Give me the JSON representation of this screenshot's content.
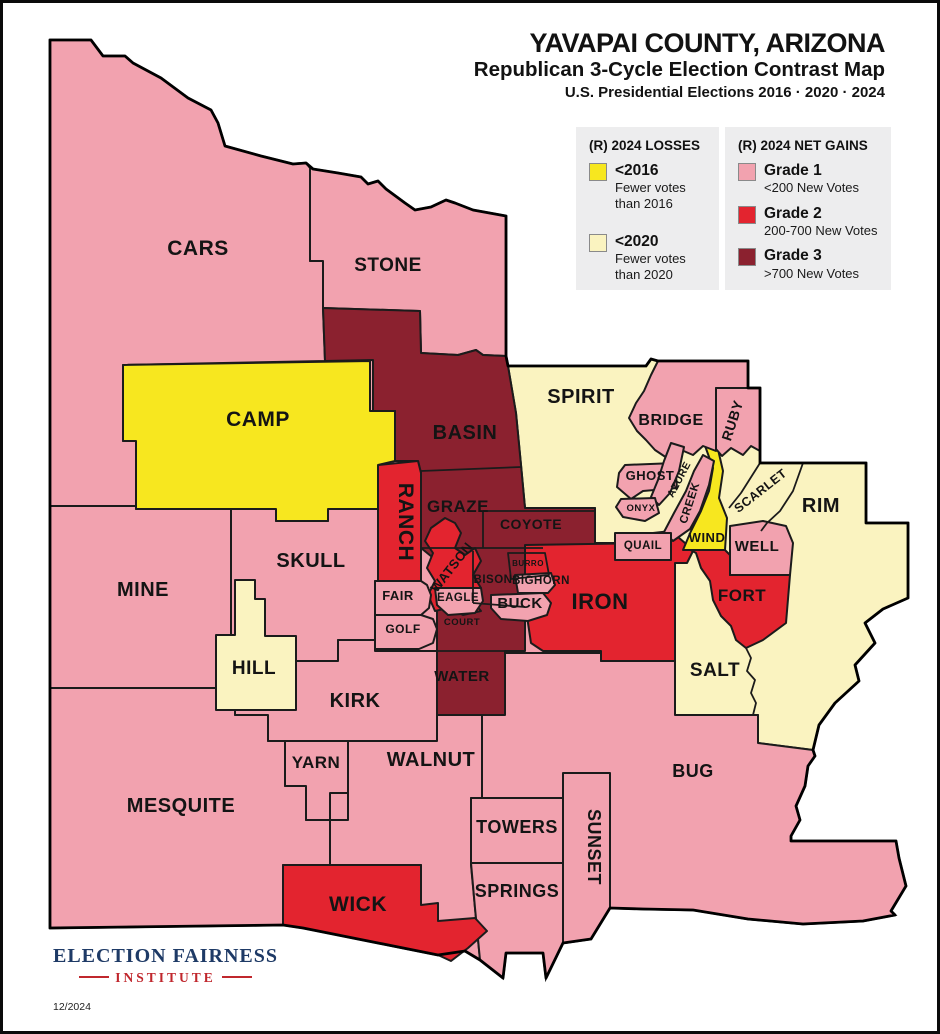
{
  "header": {
    "line1": "YAVAPAI COUNTY, ARIZONA",
    "line2": "Republican 3-Cycle Election Contrast Map",
    "line3": "U.S. Presidential Elections 2016 · 2020 · 2024"
  },
  "colors": {
    "g1": "#F2A2AF",
    "g2": "#E3242F",
    "g3": "#8B212F",
    "y16": "#F7E71F",
    "y20": "#FAF3C0",
    "stroke": "#1b1b1b",
    "legend_bg": "#EDEDEE",
    "logo_navy": "#1E3A66",
    "logo_red": "#C0272D"
  },
  "legend": {
    "losses": {
      "title": "(R) 2024 LOSSES",
      "items": [
        {
          "color_key": "y16",
          "label": "<2016",
          "desc1": "Fewer votes",
          "desc2": "than 2016"
        },
        {
          "color_key": "y20",
          "label": "<2020",
          "desc1": "Fewer votes",
          "desc2": "than 2020"
        }
      ]
    },
    "gains": {
      "title": "(R) 2024 NET GAINS",
      "items": [
        {
          "color_key": "g1",
          "label": "Grade 1",
          "desc1": "<200 New Votes"
        },
        {
          "color_key": "g2",
          "label": "Grade 2",
          "desc1": "200-700 New Votes"
        },
        {
          "color_key": "g3",
          "label": "Grade 3",
          "desc1": ">700 New Votes"
        }
      ]
    }
  },
  "footer": {
    "org1": "ELECTION FAIRNESS",
    "org2": "INSTITUTE",
    "date": "12/2024"
  },
  "map": {
    "outline": "47,37 88,37 100,53 122,53 130,60 158,75 185,95 208,107 215,120 222,143 258,153 290,161 303,160 310,166 335,170 358,174 365,181 375,178 383,186 402,200 412,207 428,204 443,197 452,200 470,207 503,213 503,353 505,363 643,363 648,356 655,358 745,358 745,385 757,385 757,460 863,460 863,520 905,520 905,595 880,606 862,620 872,640 852,662 856,678 832,700 816,722 810,747 812,753 805,763 802,783 793,803 797,817 788,833 788,838 893,838 896,855 903,883 888,908 892,912 860,918 800,921 745,916 690,907 640,906 607,905 588,936 560,940 543,975 540,950 503,950 500,975 477,957 462,948 435,952 300,925 280,922 47,925",
    "shapes": [
      {
        "name": "CARS",
        "color": "g1",
        "pts": "47,37 88,37 100,53 122,53 130,60 158,75 185,95 208,107 215,120 222,143 258,153 290,161 303,160 307,165 307,258 320,258 320,305 322,358 120,362 120,438 133,438 133,503 47,503"
      },
      {
        "name": "STONE",
        "color": "g1",
        "pts": "307,165 310,166 335,170 358,174 365,181 375,178 383,186 402,200 412,207 428,204 443,197 452,200 470,207 503,213 503,353 480,352 473,347 455,352 418,350 417,308 320,305 320,258 307,258"
      },
      {
        "name": "MINE",
        "color": "g1",
        "pts": "47,503 133,503 133,506 228,506 228,685 47,685"
      },
      {
        "name": "SKULL",
        "color": "g1",
        "pts": "228,506 273,506 273,518 325,518 325,506 375,506 375,578 372,578 372,637 335,637 335,658 228,658"
      },
      {
        "name": "MESQUITE",
        "color": "g1",
        "pts": "47,685 216,685 216,692 232,692 232,712 265,712 265,738 282,738 282,783 303,783 303,817 327,817 327,862 280,862 280,922 47,925"
      },
      {
        "name": "KIRK",
        "color": "g1",
        "pts": "228,658 335,658 335,637 372,637 372,648 434,648 434,738 265,738 265,712 232,712 232,692 216,692 216,685 228,685"
      },
      {
        "name": "YARN",
        "color": "g1",
        "pts": "282,738 345,738 345,790 327,790 327,817 303,817 303,783 282,783"
      },
      {
        "name": "WALNUT",
        "color": "g1",
        "pts": "345,738 434,738 434,712 479,712 479,795 468,795 468,862 472,905 477,957 462,948 435,952 418,905 418,862 327,862 327,817 345,817"
      },
      {
        "name": "TOWERS",
        "color": "g1",
        "pts": "468,795 560,795 560,860 468,860"
      },
      {
        "name": "SPRINGS",
        "color": "g1",
        "pts": "468,860 560,860 560,940 543,975 540,950 503,950 500,975 477,957 472,905"
      },
      {
        "name": "SUNSET",
        "color": "g1",
        "pts": "560,770 607,770 607,905 588,936 560,940"
      },
      {
        "name": "spirit-salt-rim-area",
        "color": "y20",
        "pts": "505,363 643,363 648,356 655,358 745,358 745,385 757,385 757,460 863,460 863,520 905,520 905,595 880,606 862,620 872,640 852,662 856,678 832,700 816,722 810,747 755,740 755,712 672,712 672,540 592,540 592,505 522,505 518,462 513,410"
      },
      {
        "name": "central-grade3-area",
        "color": "g3",
        "pts": "320,305 417,308 418,350 455,352 473,347 480,352 503,353 505,363 513,410 518,462 522,505 592,505 592,542 540,542 540,600 522,606 522,648 502,648 502,712 434,712 434,558 418,545 418,470 415,458 392,458 392,408 370,408 370,357 322,358"
      },
      {
        "name": "BUG",
        "color": "g1",
        "pts": "479,712 502,712 502,650 598,650 598,658 672,658 672,712 755,712 755,740 810,747 812,753 805,763 802,783 793,803 797,817 788,833 788,838 893,838 896,855 903,883 888,908 892,912 860,918 800,921 745,916 690,907 640,906 607,905 607,770 560,770 560,795 479,795"
      },
      {
        "name": "IRON",
        "color": "g2",
        "pts": "522,542 650,540 650,530 668,528 682,540 690,548 684,560 672,560 672,658 598,658 598,648 540,648 528,640 522,600"
      },
      {
        "name": "RANCH",
        "color": "g2",
        "pts": "375,462 415,458 418,470 418,578 375,578"
      },
      {
        "name": "WATSON",
        "color": "g2",
        "pts": "428,525 442,515 452,520 458,530 452,545 462,552 472,545 478,558 470,572 478,585 470,598 478,608 460,612 445,605 432,608 425,592 432,578 424,565 430,550 422,538"
      },
      {
        "name": "WICK",
        "color": "g2",
        "pts": "280,862 418,862 418,902 435,900 435,918 472,915 484,928 465,945 448,958 435,952 300,925 280,922"
      },
      {
        "name": "FORT",
        "color": "g2",
        "pts": "684,545 722,547 727,552 727,572 787,572 783,620 760,637 743,645 733,637 728,623 718,613 710,597 707,578 698,565 693,550"
      },
      {
        "name": "WIND",
        "color": "y16",
        "pts": "701,440 714,442 720,468 716,495 724,515 722,547 680,547 688,528 698,508 706,488 710,465"
      },
      {
        "name": "BRIDGE",
        "color": "g1",
        "pts": "655,358 745,358 745,385 713,385 713,448 700,443 690,452 676,446 664,455 652,447 643,437 634,428 626,415 633,400 641,388 648,372"
      },
      {
        "name": "RUBY",
        "color": "g1",
        "pts": "713,385 757,385 757,448 748,443 740,452 728,445 719,453 713,446"
      },
      {
        "name": "GHOST",
        "color": "g1",
        "pts": "622,462 672,460 674,485 640,488 628,496 614,484 616,470"
      },
      {
        "name": "AZURE",
        "color": "g1",
        "pts": "668,440 681,444 676,468 667,490 656,502 648,494 655,477 661,458"
      },
      {
        "name": "ONYX",
        "color": "g1",
        "pts": "618,496 652,495 656,510 642,518 620,514 613,504"
      },
      {
        "name": "CREEK",
        "color": "g1",
        "pts": "700,452 711,458 706,482 697,508 687,526 670,538 661,529 671,510 683,488 691,468"
      },
      {
        "name": "QUAIL",
        "color": "g1",
        "pts": "612,530 668,530 668,557 612,557"
      },
      {
        "name": "WELL",
        "color": "g1",
        "pts": "727,523 760,518 783,523 790,540 787,572 727,572"
      },
      {
        "name": "EAGLE",
        "color": "g1",
        "pts": "432,585 478,585 480,598 472,610 445,612 434,602"
      },
      {
        "name": "BUCK",
        "color": "g1",
        "pts": "488,592 540,590 548,600 544,612 525,618 498,616 488,605"
      },
      {
        "name": "BIGHORN",
        "color": "g1",
        "pts": "512,572 548,570 552,582 545,590 515,590"
      },
      {
        "name": "FAIR",
        "color": "g1",
        "pts": "372,578 418,578 424,582 428,592 426,605 418,612 372,612"
      },
      {
        "name": "GOLF",
        "color": "g1",
        "pts": "372,612 418,612 430,616 434,626 430,640 416,646 372,646"
      },
      {
        "name": "CAMP",
        "color": "y16",
        "pts": "120,362 367,358 367,408 392,408 392,458 375,462 375,506 325,506 325,518 273,518 273,506 133,506 133,438 120,438"
      },
      {
        "name": "HILL",
        "color": "y20",
        "pts": "232,577 252,577 252,596 262,596 262,633 293,633 293,707 213,707 213,632 232,632"
      }
    ],
    "lines": [
      {
        "name": "boundary-basin-graze",
        "d": "M418,468 L518,464"
      },
      {
        "name": "boundary-basin-coyote",
        "d": "M480,508 L592,508"
      },
      {
        "name": "boundary-graze-coyote",
        "d": "M480,508 L480,545"
      },
      {
        "name": "boundary-graze-bison",
        "d": "M418,545 L540,545"
      },
      {
        "name": "boundary-bison-west",
        "d": "M470,548 L470,600"
      },
      {
        "name": "boundary-bison-court",
        "d": "M470,600 L522,604"
      },
      {
        "name": "boundary-burro",
        "d": "M505,550 L542,550 L546,572 L508,576 Z"
      },
      {
        "name": "boundary-court-water",
        "d": "M434,648 L502,648"
      },
      {
        "name": "boundary-salt-rim",
        "d": "M743,645 L748,655 L744,668 L752,677 L748,690 L753,700 L750,712"
      },
      {
        "name": "boundary-scarlet-spirit",
        "d": "M757,460 L738,490 L726,505"
      },
      {
        "name": "boundary-scarlet-rim",
        "d": "M800,460 L790,488 L777,508 L764,520 L758,528"
      }
    ],
    "labels": [
      {
        "t": "CARS",
        "x": 195,
        "y": 252,
        "fs": 21
      },
      {
        "t": "STONE",
        "x": 385,
        "y": 268,
        "fs": 19
      },
      {
        "t": "CAMP",
        "x": 255,
        "y": 423,
        "fs": 21
      },
      {
        "t": "BASIN",
        "x": 462,
        "y": 436,
        "fs": 20
      },
      {
        "t": "SPIRIT",
        "x": 578,
        "y": 400,
        "fs": 20
      },
      {
        "t": "BRIDGE",
        "x": 668,
        "y": 422,
        "fs": 16
      },
      {
        "t": "RUBY",
        "x": 734,
        "y": 419,
        "fs": 14,
        "rot": -72
      },
      {
        "t": "GHOST",
        "x": 647,
        "y": 477,
        "fs": 13
      },
      {
        "t": "AZURE",
        "x": 679,
        "y": 478,
        "fs": 10.5,
        "rot": -62
      },
      {
        "t": "ONYX",
        "x": 638,
        "y": 508,
        "fs": 9.5
      },
      {
        "t": "CREEK",
        "x": 690,
        "y": 501,
        "fs": 11.5,
        "rot": -72
      },
      {
        "t": "SCARLET",
        "x": 760,
        "y": 491,
        "fs": 12.5,
        "rot": -38
      },
      {
        "t": "RIM",
        "x": 818,
        "y": 509,
        "fs": 20
      },
      {
        "t": "QUAIL",
        "x": 640,
        "y": 546,
        "fs": 11.5
      },
      {
        "t": "WIND",
        "x": 704,
        "y": 539,
        "fs": 13
      },
      {
        "t": "WELL",
        "x": 754,
        "y": 548,
        "fs": 15
      },
      {
        "t": "GRAZE",
        "x": 455,
        "y": 509,
        "fs": 17
      },
      {
        "t": "COYOTE",
        "x": 528,
        "y": 526,
        "fs": 14
      },
      {
        "t": "RANCH",
        "x": 396,
        "y": 519,
        "fs": 21,
        "rot": 90
      },
      {
        "t": "WATSON",
        "x": 452,
        "y": 567,
        "fs": 13,
        "rot": -52
      },
      {
        "t": "BURRO",
        "x": 525,
        "y": 563,
        "fs": 8
      },
      {
        "t": "BISON",
        "x": 490,
        "y": 580,
        "fs": 11.5
      },
      {
        "t": "BIGHORN",
        "x": 538,
        "y": 581,
        "fs": 11.5
      },
      {
        "t": "EAGLE",
        "x": 455,
        "y": 598,
        "fs": 11.5
      },
      {
        "t": "BUCK",
        "x": 517,
        "y": 605,
        "fs": 15
      },
      {
        "t": "IRON",
        "x": 597,
        "y": 606,
        "fs": 22
      },
      {
        "t": "FORT",
        "x": 739,
        "y": 598,
        "fs": 17
      },
      {
        "t": "FAIR",
        "x": 395,
        "y": 597,
        "fs": 13
      },
      {
        "t": "GOLF",
        "x": 400,
        "y": 630,
        "fs": 12
      },
      {
        "t": "COURT",
        "x": 459,
        "y": 622,
        "fs": 9.5
      },
      {
        "t": "SKULL",
        "x": 308,
        "y": 564,
        "fs": 20
      },
      {
        "t": "MINE",
        "x": 140,
        "y": 593,
        "fs": 20
      },
      {
        "t": "HILL",
        "x": 251,
        "y": 671,
        "fs": 19
      },
      {
        "t": "KIRK",
        "x": 352,
        "y": 704,
        "fs": 20
      },
      {
        "t": "WATER",
        "x": 459,
        "y": 678,
        "fs": 15
      },
      {
        "t": "SALT",
        "x": 712,
        "y": 673,
        "fs": 19
      },
      {
        "t": "YARN",
        "x": 313,
        "y": 765,
        "fs": 17
      },
      {
        "t": "WALNUT",
        "x": 428,
        "y": 763,
        "fs": 20
      },
      {
        "t": "MESQUITE",
        "x": 178,
        "y": 809,
        "fs": 20
      },
      {
        "t": "WICK",
        "x": 355,
        "y": 908,
        "fs": 21
      },
      {
        "t": "TOWERS",
        "x": 514,
        "y": 830,
        "fs": 18
      },
      {
        "t": "SPRINGS",
        "x": 514,
        "y": 894,
        "fs": 18
      },
      {
        "t": "SUNSET",
        "x": 585,
        "y": 844,
        "fs": 18,
        "rot": 90
      },
      {
        "t": "BUG",
        "x": 690,
        "y": 774,
        "fs": 18
      }
    ]
  }
}
